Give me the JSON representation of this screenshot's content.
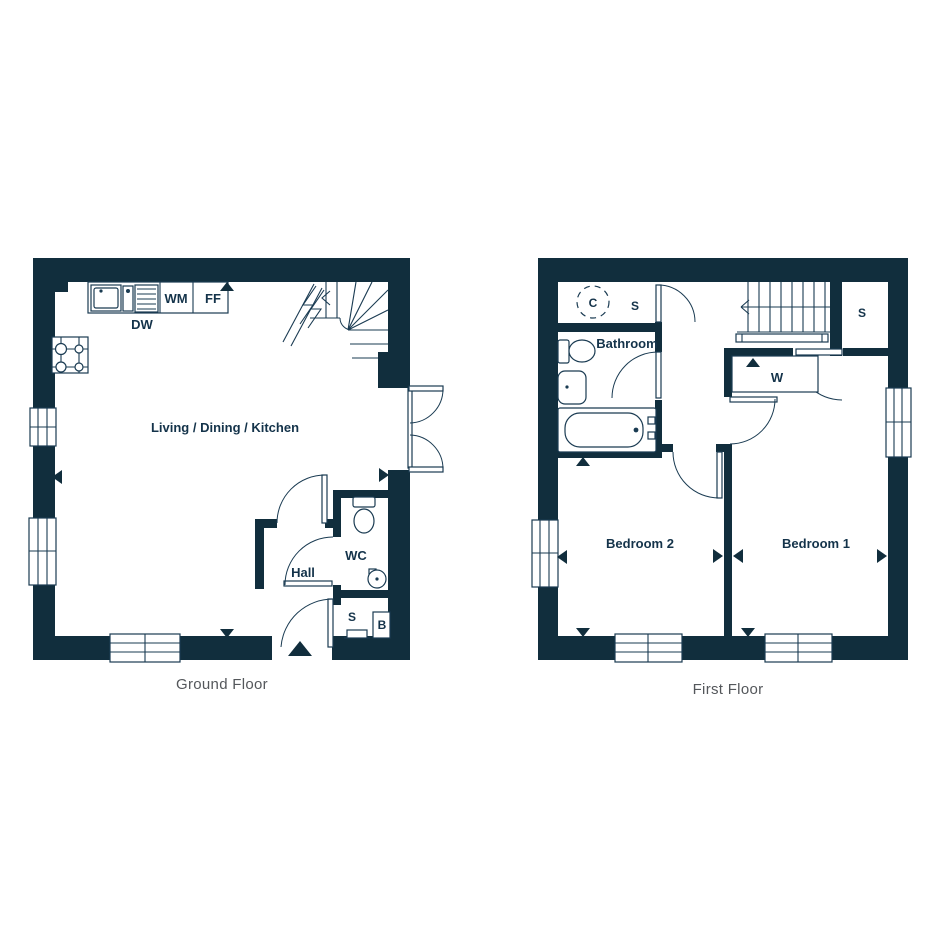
{
  "page": {
    "background_color": "#ffffff"
  },
  "colors": {
    "wall_fill": "#112e3d",
    "line": "#1a3b52",
    "label_navy": "#14334a",
    "floor_title_gray": "#54575b"
  },
  "ground_floor": {
    "title": "Ground Floor",
    "room_labels": {
      "living_dining_kitchen": "Living / Dining / Kitchen",
      "hall": "Hall",
      "wc": "WC",
      "store": "S",
      "boiler": "B"
    },
    "appliance_labels": {
      "dishwasher": "DW",
      "washing_machine": "WM",
      "fridge_freezer": "FF"
    }
  },
  "first_floor": {
    "title": "First Floor",
    "room_labels": {
      "bathroom": "Bathroom",
      "bedroom_1": "Bedroom 1",
      "bedroom_2": "Bedroom 2",
      "wardrobe": "W",
      "cylinder": "C",
      "landing_store": "S",
      "bedroom_store": "S"
    }
  }
}
